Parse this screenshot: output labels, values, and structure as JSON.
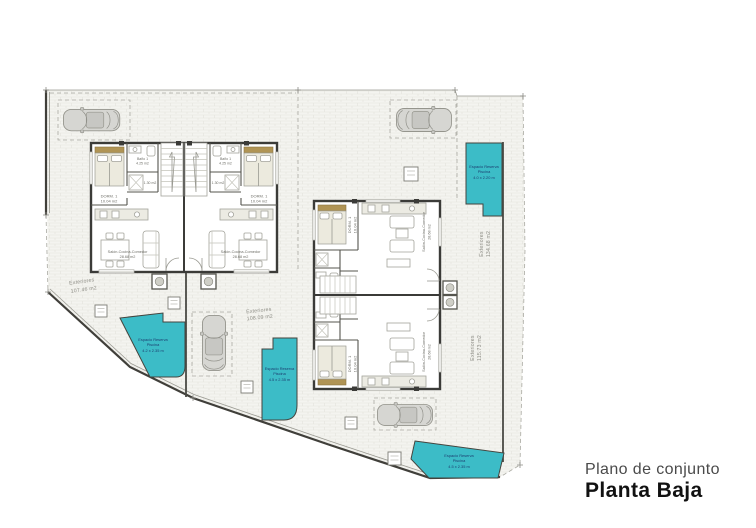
{
  "title": {
    "subtitle": "Plano de conjunto",
    "main": "Planta Baja"
  },
  "rooms": {
    "bedroom": {
      "name": "DORM. 1",
      "area": "10.04 m2"
    },
    "bath": {
      "name": "Baño 1",
      "area": "4.25 m2"
    },
    "closet": {
      "area": "1.30 m2"
    },
    "living": {
      "name": "Salón-Cocina-Comedor",
      "area": "28.68 m2"
    }
  },
  "exteriores": [
    {
      "label": "Exteriores",
      "area": "107.46 m2"
    },
    {
      "label": "Exteriores",
      "area": "108.09 m2"
    },
    {
      "label": "Exteriores",
      "area": "134.68 m2"
    },
    {
      "label": "Exteriores",
      "area": "115.73 m2"
    }
  ],
  "pools": [
    {
      "l1": "Espacio Reserva",
      "l2": "Piscina",
      "l3": "4.2 x 2.35 m"
    },
    {
      "l1": "Espacio Reserva",
      "l2": "Piscina",
      "l3": "4.5 x 2.35 m"
    },
    {
      "l1": "Espacio Reserva",
      "l2": "Piscina",
      "l3": "4.0 x 2.20 m"
    },
    {
      "l1": "Espacio Reserva",
      "l2": "Piscina",
      "l3": "4.5 x 2.35 m"
    }
  ],
  "colors": {
    "pool": "#3cbcc7",
    "pool_text": "#1d3e70",
    "wall": "#3b3b38",
    "paving": "#f4f4f0",
    "title_main": "#111111",
    "title_sub": "#4a4a4a"
  }
}
